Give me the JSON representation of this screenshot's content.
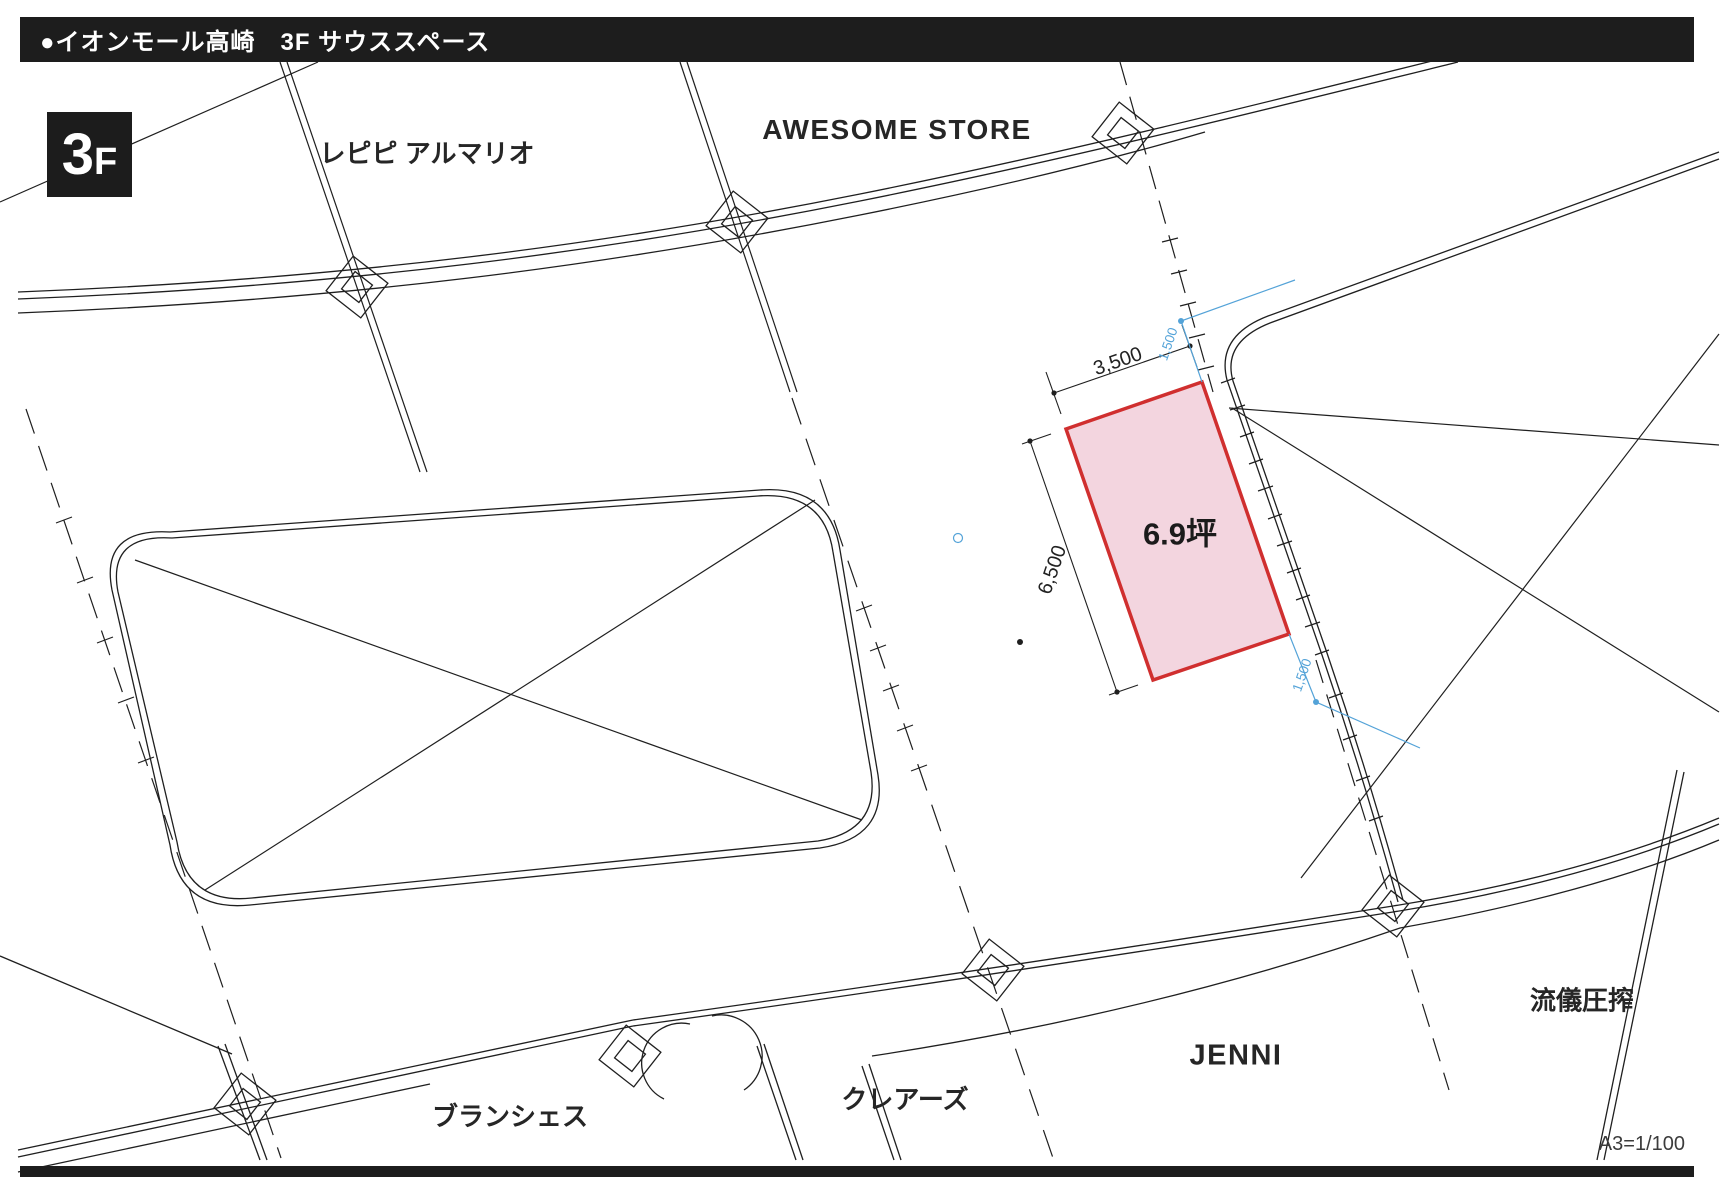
{
  "header": {
    "title": "●イオンモール高崎　3F サウススペース"
  },
  "floor_badge": {
    "number": "3",
    "suffix": "F"
  },
  "stores": {
    "repipi": {
      "label": "レピピ アルマリオ"
    },
    "awesome": {
      "label": "AWESOME STORE"
    },
    "branshes": {
      "label": "ブランシェス"
    },
    "claires": {
      "label": "クレアーズ"
    },
    "jenni": {
      "label": "JENNI"
    },
    "ryugi": {
      "label": "流儀圧搾"
    }
  },
  "space": {
    "area_label": "6.9坪",
    "dim_width": "3,500",
    "dim_depth": "6,500",
    "dim_offset_top": "1,500",
    "dim_offset_bottom": "1,500",
    "fill_color": "#f3d5df",
    "border_color": "#d02f2f"
  },
  "scale_note": "A3=1/100",
  "colors": {
    "line": "#1f1f1f",
    "dimension_blue": "#54a3d8",
    "bar_black": "#1d1d1d"
  }
}
